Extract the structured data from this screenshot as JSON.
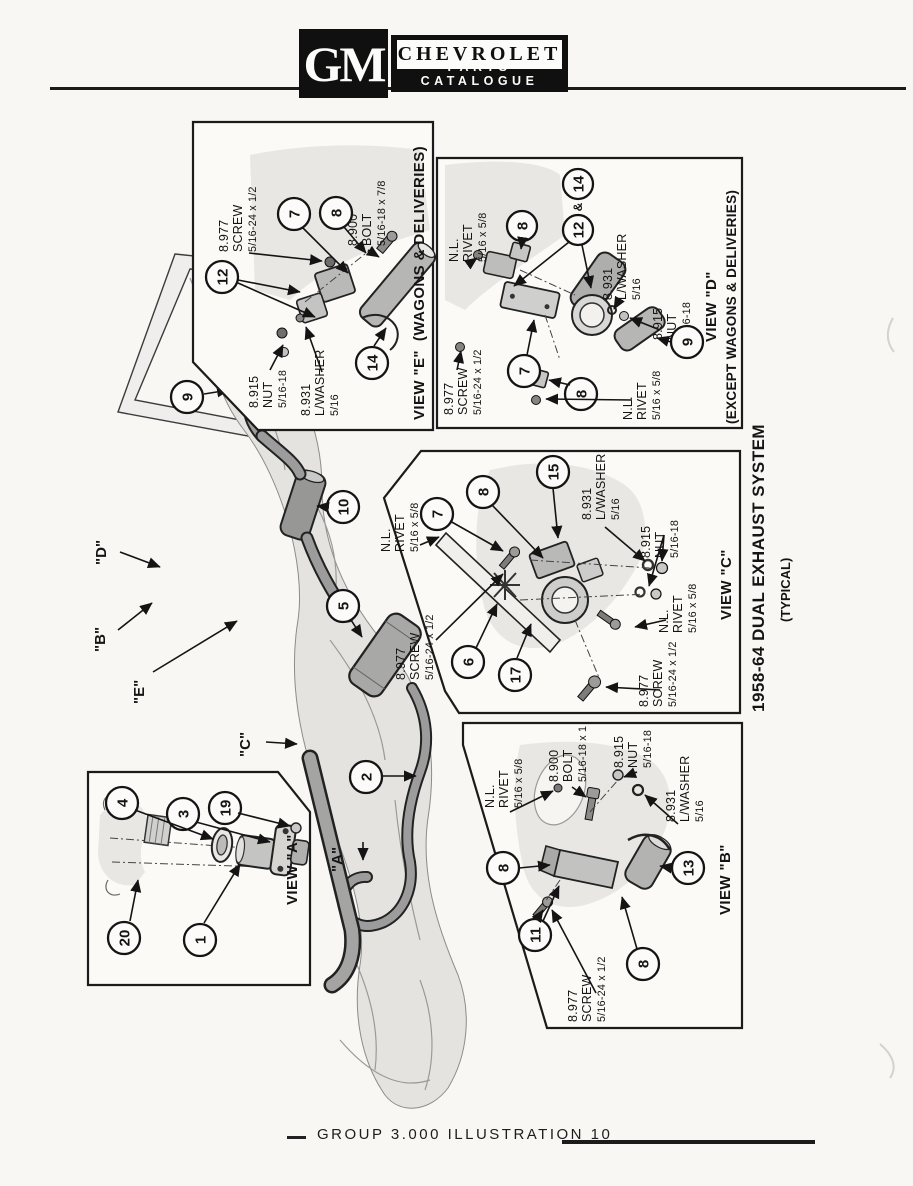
{
  "header": {
    "logo": "GM",
    "brand": "CHEVROLET",
    "subtitle": "PARTS CATALOGUE"
  },
  "footer": {
    "label": "GROUP 3.000 ILLUSTRATION 10"
  },
  "side_title": {
    "line1": "1958-64 DUAL EXHAUST SYSTEM",
    "line2": "(TYPICAL)"
  },
  "main": {
    "callouts": {
      "c9": "9",
      "c10": "10",
      "c5": "5",
      "c2": "2"
    },
    "letters": {
      "d": "\"D\"",
      "b": "\"B\"",
      "e": "\"E\"",
      "c": "\"C\"",
      "a": "\"A\""
    }
  },
  "view_e": {
    "title": "VIEW \"E\"",
    "subtitle": "(WAGONS & DELIVERIES)",
    "parts": {
      "screw": {
        "num": "8.977",
        "name": "SCREW",
        "size": "5/16-24 x 1/2"
      },
      "bolt": {
        "num": "8.900",
        "name": "BOLT",
        "size": "5/16-18 x 7/8"
      },
      "nut": {
        "num": "8.915",
        "name": "NUT",
        "size": "5/16-18"
      },
      "lwasher": {
        "num": "8.931",
        "name": "L/WASHER",
        "size": "5/16"
      }
    },
    "callouts": {
      "c12": "12",
      "c7": "7",
      "c8": "8",
      "c14": "14"
    }
  },
  "view_d": {
    "title": "VIEW \"D\"",
    "subtitle": "(EXCEPT WAGONS & DELIVERIES)",
    "parts": {
      "rivet_top": {
        "num": "N.L.",
        "name": "RIVET",
        "size": "5/16 x 5/8"
      },
      "lwasher": {
        "num": "8.931",
        "name": "L/WASHER",
        "size": "5/16"
      },
      "nut": {
        "num": "8.915",
        "name": "NUT",
        "size": "5/16-18"
      },
      "screw": {
        "num": "8.977",
        "name": "SCREW",
        "size": "5/16-24 x 1/2"
      },
      "rivet_bottom": {
        "num": "N.L.",
        "name": "RIVET",
        "size": "5/16 x 5/8"
      }
    },
    "callouts": {
      "c8a": "8",
      "c12": "12",
      "amp": "&",
      "c14": "14",
      "c7": "7",
      "c8b": "8",
      "c9": "9"
    }
  },
  "view_c": {
    "title": "VIEW \"C\"",
    "parts": {
      "rivet_left": {
        "num": "N.L.",
        "name": "RIVET",
        "size": "5/16 x 5/8"
      },
      "screw_left": {
        "num": "8.977",
        "name": "SCREW",
        "size": "5/16-24 x 1/2"
      },
      "lwasher": {
        "num": "8.931",
        "name": "L/WASHER",
        "size": "5/16"
      },
      "nut": {
        "num": "8.915",
        "name": "NUT",
        "size": "5/16-18"
      },
      "rivet_right": {
        "num": "N.L.",
        "name": "RIVET",
        "size": "5/16 x 5/8"
      },
      "screw_bottom": {
        "num": "8.977",
        "name": "SCREW",
        "size": "5/16-24 x 1/2"
      }
    },
    "callouts": {
      "c7": "7",
      "c8": "8",
      "c15": "15",
      "c6": "6",
      "c17": "17"
    }
  },
  "view_a": {
    "title": "VIEW \"A\"",
    "callouts": {
      "c4": "4",
      "c3": "3",
      "c19": "19",
      "c20": "20",
      "c1": "1"
    }
  },
  "view_b": {
    "title": "VIEW \"B\"",
    "parts": {
      "rivet": {
        "num": "N.L.",
        "name": "RIVET",
        "size": "5/16 x 5/8"
      },
      "bolt": {
        "num": "8.900",
        "name": "BOLT",
        "size": "5/16-18 x 1"
      },
      "nut": {
        "num": "8.915",
        "name": "NUT",
        "size": "5/16-18"
      },
      "lwasher": {
        "num": "8.931",
        "name": "L/WASHER",
        "size": "5/16"
      },
      "screw": {
        "num": "8.977",
        "name": "SCREW",
        "size": "5/16-24 x 1/2"
      }
    },
    "callouts": {
      "c8a": "8",
      "c11": "11",
      "c13": "13",
      "c8b": "8"
    }
  }
}
